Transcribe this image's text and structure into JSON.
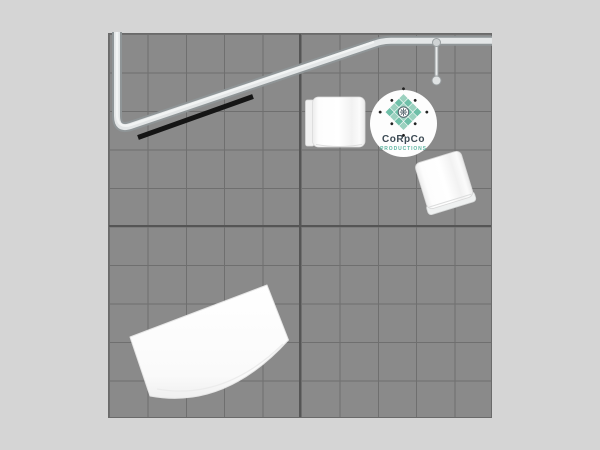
{
  "window": {
    "background_color": "#d5d5d5"
  },
  "floor": {
    "color": "#8a8a8a",
    "grid_line_color": "#6f6f6f",
    "grid_center_seam_color": "#555555",
    "columns": 10,
    "rows": 10
  },
  "structure": {
    "truss_fill_color": "#e3e6e7",
    "truss_edge_color": "#8f9597",
    "header_bar_color": "#151515",
    "pole_knob_color": "#dfe2e3"
  },
  "furniture": {
    "counter_color": "#fafafa",
    "items": [
      "small-counter",
      "angled-counter",
      "curved-reception-counter"
    ]
  },
  "logo": {
    "line1": "CoRpCo",
    "line2": "PRODUCTIONS",
    "disc_color": "#fdfdfd",
    "teal_light": "#9bd1bf",
    "teal_dark": "#6fbfa8",
    "dot_color": "#222222",
    "emblem_ring_color": "#54636b",
    "text_color": "#3c4a54",
    "subtext_color": "#5fb6a2"
  }
}
